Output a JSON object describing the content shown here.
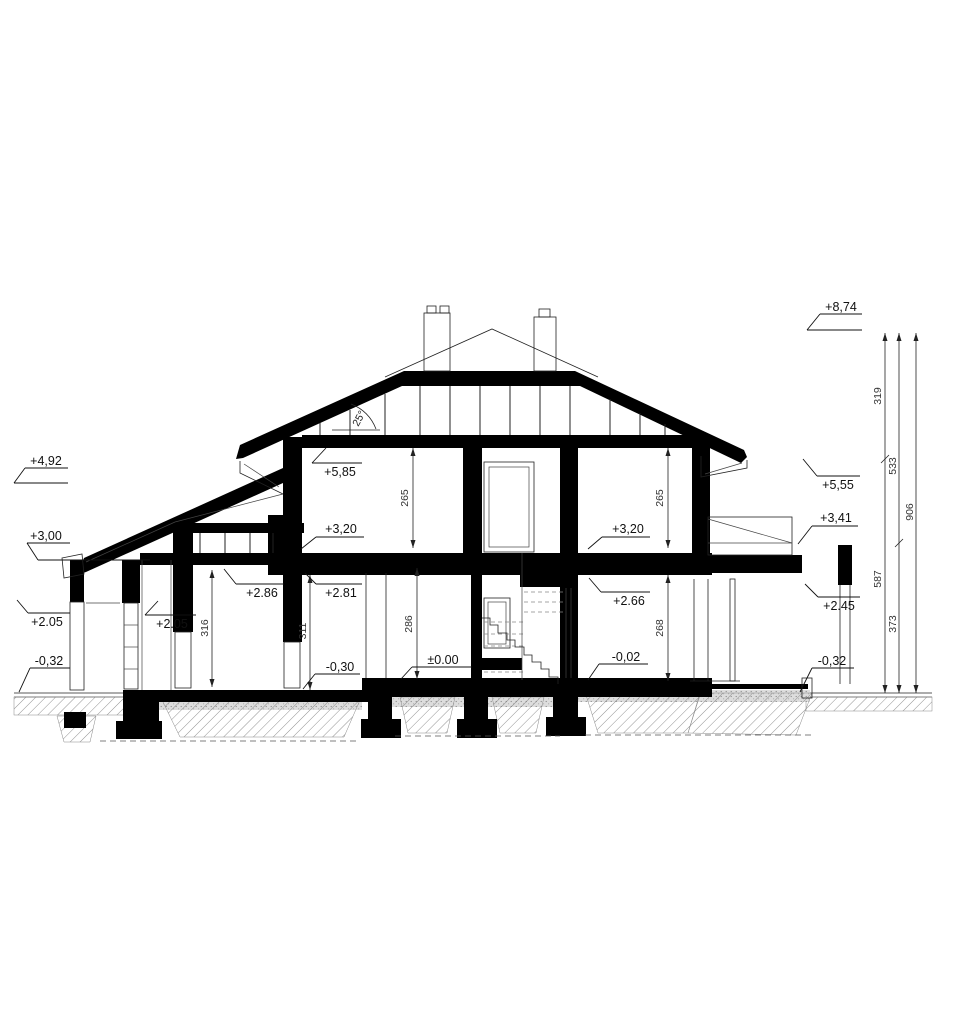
{
  "drawing_type": "house-cross-section",
  "angle": {
    "label": "25°"
  },
  "levels": {
    "l492": "+4,92",
    "l300": "+3,00",
    "l205a": "+2.05",
    "lm032a": "-0,32",
    "l205b": "+2.05",
    "l286": "+2.86",
    "l281": "+2.81",
    "lm030": "-0,30",
    "l000": "±0.00",
    "l585": "+5,85",
    "l320a": "+3,20",
    "l320b": "+3,20",
    "l266": "+2.66",
    "lm002": "-0,02",
    "l874": "+8,74",
    "l555": "+5,55",
    "l341": "+3,41",
    "l245": "+2.45",
    "lm032b": "-0,32"
  },
  "dims": {
    "d316": "316",
    "d311": "311",
    "d286": "286",
    "d268": "268",
    "d265a": "265",
    "d265b": "265",
    "d319": "319",
    "d533": "533",
    "d906": "906",
    "d587": "587",
    "d373": "373"
  },
  "colors": {
    "ink": "#000000",
    "paper": "#ffffff",
    "soil": "#aaaaaa"
  }
}
